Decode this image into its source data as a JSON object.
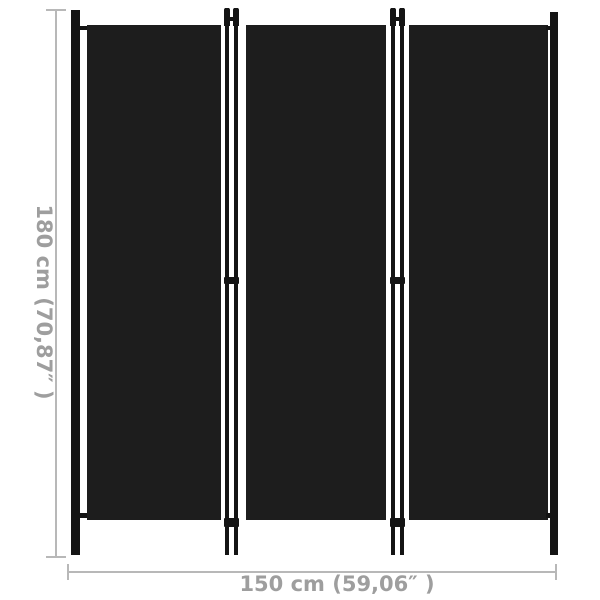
{
  "diagram": {
    "subject": "three-panel-room-divider",
    "panel_count": 3
  },
  "dimensions": {
    "height_label": "180 cm (70,87″ )",
    "width_label": "150 cm (59,06″ )"
  },
  "colors": {
    "panel_fabric": "#1d1d1d",
    "frame": "#141414",
    "dimension_line": "#b8b8b8",
    "dimension_text": "#9e9e9e",
    "background": "#ffffff"
  }
}
